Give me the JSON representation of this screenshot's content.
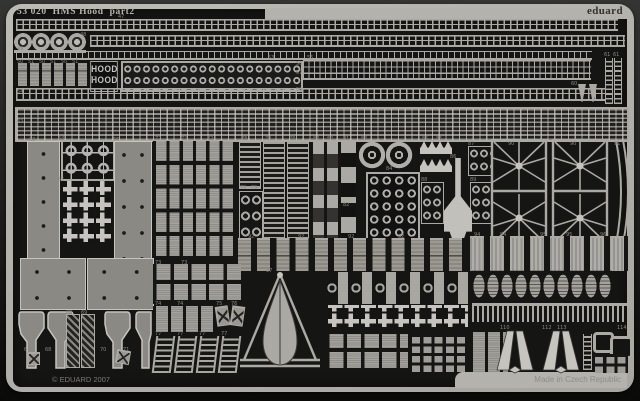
{
  "header": {
    "title": "53 020  HMS Hood  part2",
    "brand": "eduard"
  },
  "footer": {
    "copyright": "© EDUARD 2007",
    "made_in": "Made in Czech Republic"
  },
  "nameplate": {
    "line1": "HOOD",
    "line2": "HOOD"
  },
  "colors": {
    "outer_top": "#343432",
    "outer_bottom": "#0a0a08",
    "frame": "#b4b2ac",
    "interior": "#151513",
    "part_light": "#aba9a3",
    "part_bright": "#c6c4be",
    "part_mid": "#8b8983",
    "part_dark": "#34322e",
    "label": "#8a8880",
    "title_text": "#b6b4ae",
    "brand_text": "#32322e",
    "madein_text": "#8e8c86",
    "copyright_text": "#7d7b75"
  },
  "part_labels": [
    {
      "n": "47",
      "x": 118,
      "y": 15
    },
    {
      "n": "48",
      "x": 80,
      "y": 33
    },
    {
      "n": "49",
      "x": 17,
      "y": 47
    },
    {
      "n": "50",
      "x": 17,
      "y": 60
    },
    {
      "n": "51",
      "x": 28,
      "y": 60
    },
    {
      "n": "50",
      "x": 39,
      "y": 60
    },
    {
      "n": "51",
      "x": 50,
      "y": 60
    },
    {
      "n": "50",
      "x": 61,
      "y": 60
    },
    {
      "n": "51",
      "x": 72,
      "y": 60
    },
    {
      "n": "52",
      "x": 90,
      "y": 77
    },
    {
      "n": "53",
      "x": 268,
      "y": 56
    },
    {
      "n": "54",
      "x": 17,
      "y": 90
    },
    {
      "n": "55",
      "x": 307,
      "y": 56
    },
    {
      "n": "56",
      "x": 296,
      "y": 62
    },
    {
      "n": "57",
      "x": 296,
      "y": 71
    },
    {
      "n": "59",
      "x": 296,
      "y": 88
    },
    {
      "n": "60",
      "x": 571,
      "y": 82
    },
    {
      "n": "61",
      "x": 604,
      "y": 53
    },
    {
      "n": "61",
      "x": 613,
      "y": 53
    },
    {
      "n": "62",
      "x": 17,
      "y": 120
    },
    {
      "n": "63",
      "x": 29,
      "y": 138
    },
    {
      "n": "64",
      "x": 58,
      "y": 137
    },
    {
      "n": "65",
      "x": 58,
      "y": 178
    },
    {
      "n": "66",
      "x": 113,
      "y": 138
    },
    {
      "n": "72",
      "x": 155,
      "y": 137
    },
    {
      "n": "72",
      "x": 181,
      "y": 137
    },
    {
      "n": "72",
      "x": 207,
      "y": 137
    },
    {
      "n": "78",
      "x": 241,
      "y": 137
    },
    {
      "n": "78",
      "x": 265,
      "y": 137
    },
    {
      "n": "78",
      "x": 289,
      "y": 137
    },
    {
      "n": "79",
      "x": 240,
      "y": 186
    },
    {
      "n": "79",
      "x": 251,
      "y": 186
    },
    {
      "n": "80",
      "x": 313,
      "y": 137
    },
    {
      "n": "80",
      "x": 327,
      "y": 137
    },
    {
      "n": "81",
      "x": 343,
      "y": 137
    },
    {
      "n": "82",
      "x": 343,
      "y": 203
    },
    {
      "n": "83",
      "x": 361,
      "y": 137
    },
    {
      "n": "84",
      "x": 386,
      "y": 167
    },
    {
      "n": "85",
      "x": 422,
      "y": 137
    },
    {
      "n": "85",
      "x": 436,
      "y": 137
    },
    {
      "n": "86",
      "x": 450,
      "y": 155
    },
    {
      "n": "88",
      "x": 421,
      "y": 178
    },
    {
      "n": "89",
      "x": 470,
      "y": 178
    },
    {
      "n": "87",
      "x": 468,
      "y": 142
    },
    {
      "n": "90",
      "x": 508,
      "y": 142
    },
    {
      "n": "90",
      "x": 570,
      "y": 142
    },
    {
      "n": "91",
      "x": 614,
      "y": 142
    },
    {
      "n": "92",
      "x": 248,
      "y": 235
    },
    {
      "n": "92",
      "x": 298,
      "y": 235
    },
    {
      "n": "92",
      "x": 348,
      "y": 235
    },
    {
      "n": "92",
      "x": 398,
      "y": 235
    },
    {
      "n": "94",
      "x": 474,
      "y": 233
    },
    {
      "n": "94",
      "x": 500,
      "y": 233
    },
    {
      "n": "95",
      "x": 540,
      "y": 233
    },
    {
      "n": "95",
      "x": 566,
      "y": 233
    },
    {
      "n": "96",
      "x": 600,
      "y": 233
    },
    {
      "n": "73",
      "x": 155,
      "y": 261
    },
    {
      "n": "73",
      "x": 181,
      "y": 261
    },
    {
      "n": "74",
      "x": 155,
      "y": 302
    },
    {
      "n": "74",
      "x": 177,
      "y": 302
    },
    {
      "n": "75",
      "x": 216,
      "y": 302
    },
    {
      "n": "76",
      "x": 231,
      "y": 302
    },
    {
      "n": "77",
      "x": 155,
      "y": 332
    },
    {
      "n": "77",
      "x": 177,
      "y": 332
    },
    {
      "n": "77",
      "x": 199,
      "y": 332
    },
    {
      "n": "77",
      "x": 221,
      "y": 332
    },
    {
      "n": "97",
      "x": 266,
      "y": 269
    },
    {
      "n": "67",
      "x": 24,
      "y": 348
    },
    {
      "n": "68",
      "x": 45,
      "y": 348
    },
    {
      "n": "69",
      "x": 66,
      "y": 311
    },
    {
      "n": "69",
      "x": 81,
      "y": 311
    },
    {
      "n": "70",
      "x": 100,
      "y": 348
    },
    {
      "n": "71",
      "x": 123,
      "y": 348
    },
    {
      "n": "110",
      "x": 500,
      "y": 326
    },
    {
      "n": "112",
      "x": 542,
      "y": 326
    },
    {
      "n": "113",
      "x": 557,
      "y": 326
    },
    {
      "n": "114",
      "x": 617,
      "y": 326
    }
  ]
}
